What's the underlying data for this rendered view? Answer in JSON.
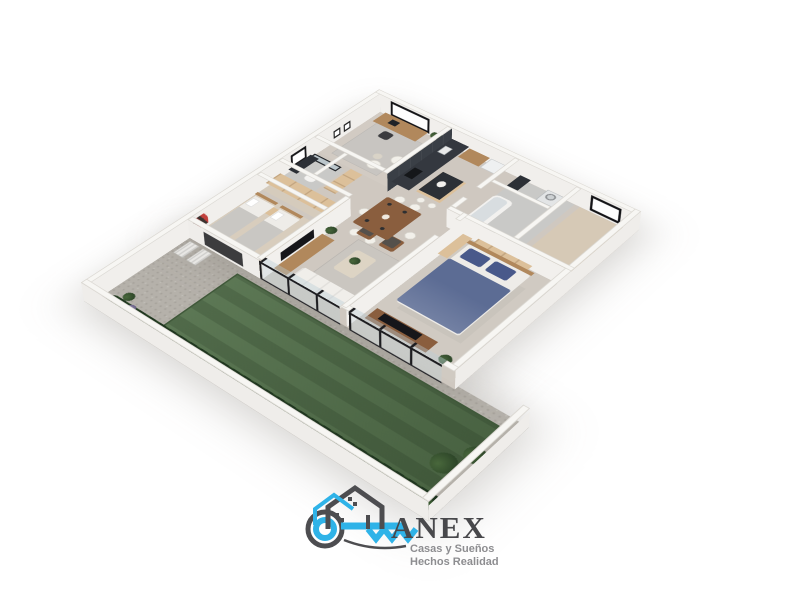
{
  "page": {
    "background": "#ffffff"
  },
  "logo": {
    "brand": "ANEX",
    "tagline_line1": "Casas y Sueños",
    "tagline_line2": "Hechos Realidad",
    "icons": [
      "key-icon",
      "house-outline-icon"
    ]
  },
  "palette": {
    "logo_cyan": "#2fb3e8",
    "logo_gray": "#4d4d50",
    "brand_text": "#48484b",
    "tagline_text": "#8d8d90",
    "wall_top": "#f7f6f3",
    "wall_face": "#efedea",
    "wall_edge": "#d9d6d0",
    "floor_main": "#cfc8c0",
    "floor_beda": "#d8cdbd",
    "floor_master": "#d0cac2",
    "floor_bath": "#c9c9c7",
    "floor_empty": "#d6c9b6",
    "floor_study": "#d2cbc3",
    "gravel": "#b5b1aa",
    "gravel_dot": "#a19d96",
    "lawn": "#53704b",
    "hedge": "#2c452a",
    "wood_light": "#dcc09a",
    "wood_mid": "#b1885c",
    "wood_dark": "#8a5e3e",
    "dark_unit": "#34383f",
    "counter_dark": "#2c3036",
    "tv_black": "#16161a",
    "bed_navy": "#5c6c94",
    "pillow_navy": "#49598a",
    "bedding_white": "#eeece8",
    "sofa_white": "#f0eeea",
    "glass_frame": "#1d1d20"
  }
}
